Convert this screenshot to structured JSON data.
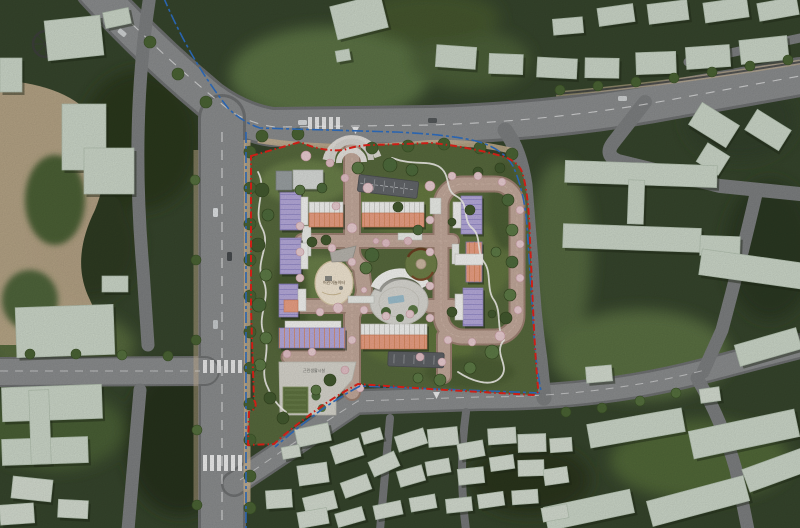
{
  "scene": {
    "description": "Aerial photomontage site plan of an apartment complex surrounded by existing neighborhood",
    "language": "ko"
  },
  "site": {
    "boundary_line": {
      "color": "#e32219",
      "style": "red-dashed"
    },
    "district_line": {
      "color": "#2f6fc2",
      "style": "blue-dash-dot"
    },
    "labels": {
      "playground": "어린이놀이터",
      "neighborhood_facility": "근린생활시설"
    },
    "building_palette": {
      "type_a_tower": "#b6aadb",
      "type_b_row": "#eba084",
      "core_white": "#f3f3f1",
      "community_gray": "#d8dbd8"
    },
    "landscape": {
      "internal_road": "#c3a99b",
      "plaza": "#d9d8d2",
      "playground_surface": "#f1e6d2",
      "cherry_tree": "#e9cdd1",
      "green_tree": "#4e6b3c",
      "trail": "#f5f3ee"
    },
    "features": [
      "loop-road",
      "central-plaza",
      "children-playground",
      "circular-garden",
      "perimeter-walking-trail",
      "underground-parking-ramp",
      "street-parking"
    ]
  },
  "context": {
    "palette": {
      "forest": "#36452c",
      "field": "#5c7344",
      "road": "#8b8d8e",
      "existing_building": "#ccd7c9",
      "sidewalk": "#c8b393"
    },
    "elements": [
      "campus-west",
      "school-southwest",
      "village-south",
      "housing-slabs-east",
      "shops-north"
    ]
  }
}
